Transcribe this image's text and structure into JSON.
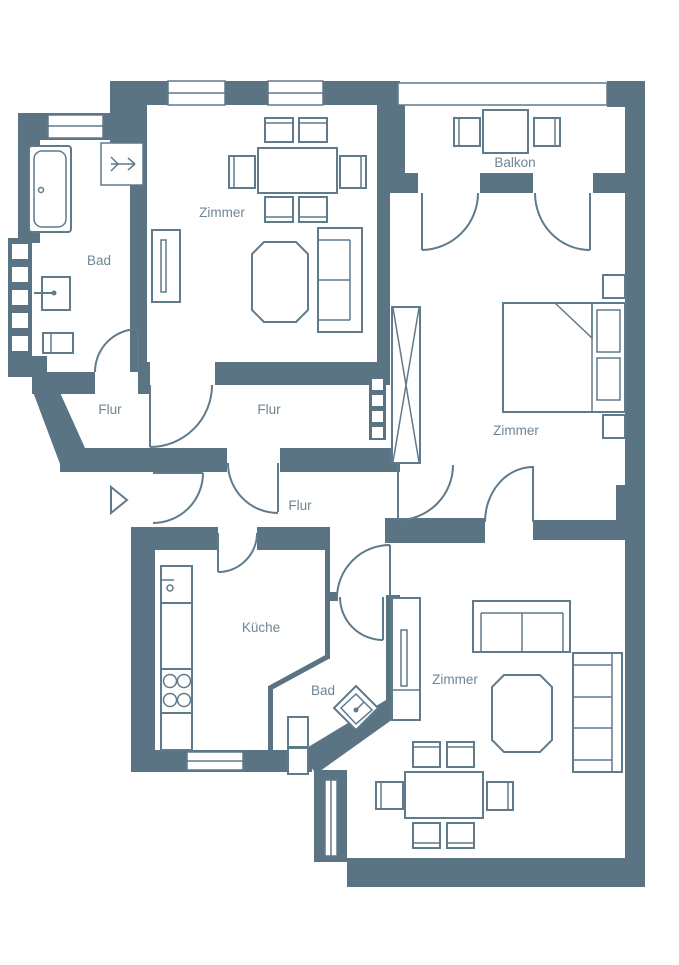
{
  "colors": {
    "wall": "#5a7484",
    "furniture": "#5f7a8a",
    "label": "#6e8694",
    "background": "#ffffff"
  },
  "rooms": [
    {
      "id": "zimmer-top-left",
      "label": "Zimmer"
    },
    {
      "id": "bad-top-left",
      "label": "Bad"
    },
    {
      "id": "balkon",
      "label": "Balkon"
    },
    {
      "id": "zimmer-bedroom",
      "label": "Zimmer"
    },
    {
      "id": "flur-west",
      "label": "Flur"
    },
    {
      "id": "flur-center",
      "label": "Flur"
    },
    {
      "id": "flur-south",
      "label": "Flur"
    },
    {
      "id": "kueche",
      "label": "Küche"
    },
    {
      "id": "bad-small",
      "label": "Bad"
    },
    {
      "id": "zimmer-living",
      "label": "Zimmer"
    }
  ]
}
